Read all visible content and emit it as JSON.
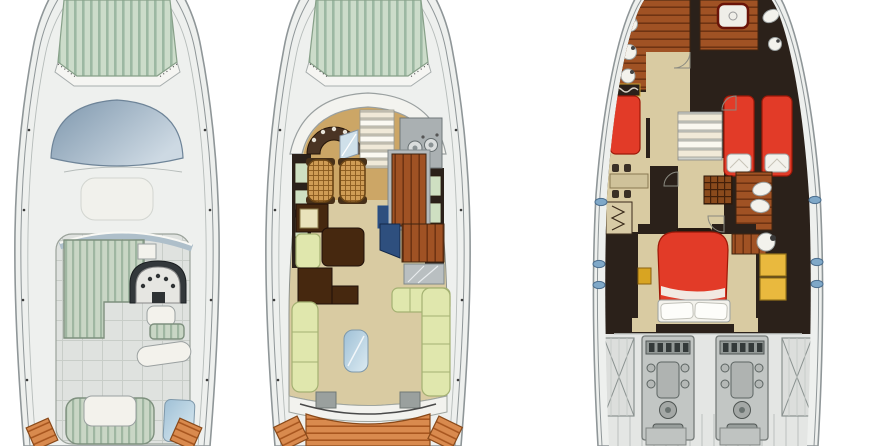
{
  "page": {
    "background": "#ffffff",
    "description": "three-view yacht deck plan drawing"
  },
  "palette": {
    "page_bg": "#ffffff",
    "hull_line": "#8f9698",
    "hull_fill": "#eef0ee",
    "deck_fill": "#f5f5f2",
    "tile_gray": "#dfe2df",
    "tile_line": "#c8cdc8",
    "sunpad": "#ccdcca",
    "sunpad_stripe": "#9cb8a2",
    "flyseat": "#c9d6c5",
    "flyseat_stripe": "#9fb6a1",
    "windshield_dark": "#7e97ad",
    "windshield_light": "#cdd9e3",
    "glass_blue": "#9fc0d6",
    "teak": "#d98a4e",
    "teak_dark": "#a8561f",
    "floor_beige": "#d9cba2",
    "helm_floor": "#c9a05c",
    "sofa_green": "#e0e7ad",
    "sofa_line": "#a4b172",
    "furniture_brown": "#46280f",
    "wood_floor": "#a05224",
    "wood_line": "#6f3312",
    "bed_red": "#e23b28",
    "bed_red_dark": "#9d1808",
    "cabinet_yellow": "#e9b93e",
    "wall_dark": "#2b211a",
    "counter_gray": "#aab0b2",
    "engine_bg": "#e4e6e4",
    "engine_gray": "#c2c6c4",
    "fixture_white": "#f3f2ec",
    "porthole_blue": "#7fa8c8",
    "tv_blue": "#2e4f7e",
    "wicker": "#cf9c55",
    "wicker_line": "#8a5a1e"
  },
  "plans": [
    {
      "id": "flybridge",
      "label": "flybridge-deck-plan"
    },
    {
      "id": "main-deck",
      "label": "main-deck-plan"
    },
    {
      "id": "lower-deck",
      "label": "lower-deck-and-engine-room-plan"
    }
  ]
}
